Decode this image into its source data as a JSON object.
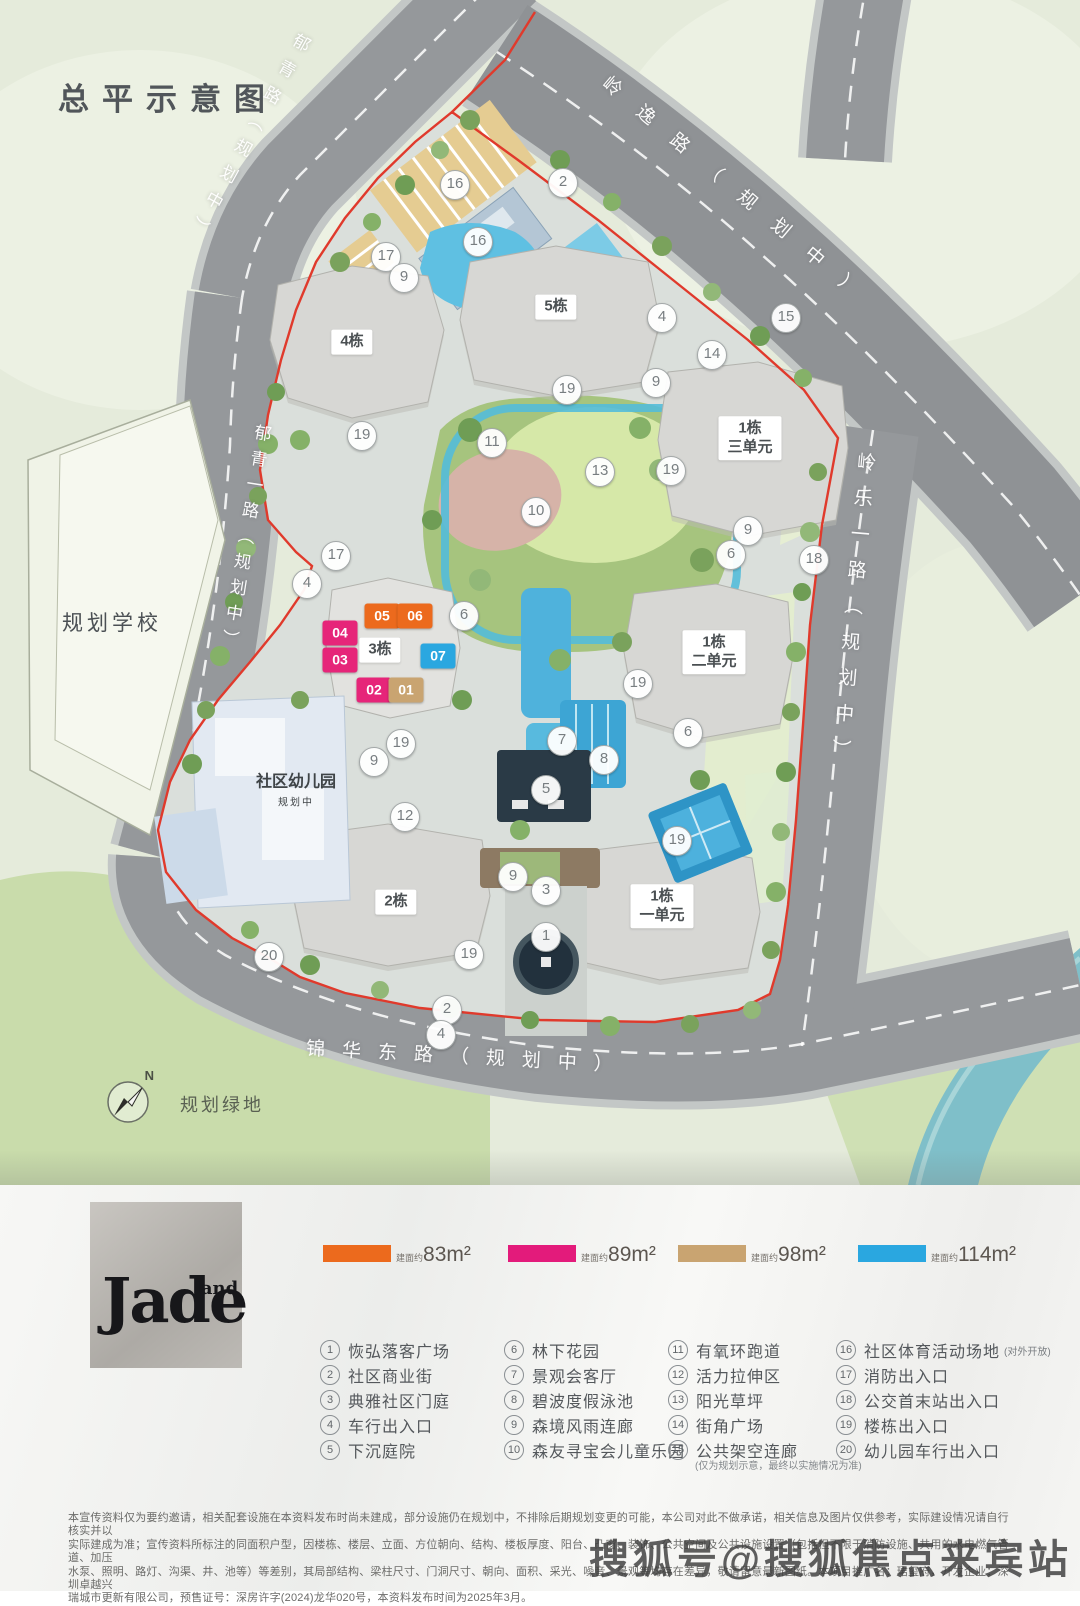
{
  "page_title": "总平示意图",
  "map": {
    "road_labels": {
      "yuqing": "郁青路（规划中）",
      "yuqing_yi": "郁青一路（规划中）",
      "lingyi": "岭逸路（规划中）",
      "lingle_yi": "岭乐一路（规划中）",
      "jinhua_east": "锦华东路（规划中）"
    },
    "area_labels": {
      "school": "规划学校",
      "kindergarten": "社区幼儿园",
      "kindergarten_note": "规划中",
      "green_space": "规划绿地",
      "compass": "N"
    },
    "building_labels": {
      "b4": "4栋",
      "b5": "5栋",
      "b3": "3栋",
      "b2": "2栋",
      "b1u3": "1栋\n三单元",
      "b1u2": "1栋\n二单元",
      "b1u1": "1栋\n一单元"
    },
    "unit_blocks": [
      {
        "no": "05",
        "color": "#EC6A1D",
        "x": 382,
        "y": 616
      },
      {
        "no": "06",
        "color": "#EC6A1D",
        "x": 415,
        "y": 616
      },
      {
        "no": "04",
        "color": "#E62579",
        "x": 340,
        "y": 633
      },
      {
        "no": "03",
        "color": "#E62579",
        "x": 340,
        "y": 660
      },
      {
        "no": "07",
        "color": "#2AA7E0",
        "x": 438,
        "y": 656
      },
      {
        "no": "02",
        "color": "#E62579",
        "x": 374,
        "y": 690
      },
      {
        "no": "01",
        "color": "#C9A471",
        "x": 406,
        "y": 690
      }
    ],
    "markers": [
      {
        "n": "16",
        "x": 455,
        "y": 185
      },
      {
        "n": "2",
        "x": 563,
        "y": 183
      },
      {
        "n": "17",
        "x": 386,
        "y": 257
      },
      {
        "n": "16",
        "x": 478,
        "y": 242
      },
      {
        "n": "9",
        "x": 404,
        "y": 278
      },
      {
        "n": "4",
        "x": 662,
        "y": 318
      },
      {
        "n": "15",
        "x": 786,
        "y": 318
      },
      {
        "n": "14",
        "x": 712,
        "y": 355
      },
      {
        "n": "9",
        "x": 656,
        "y": 383
      },
      {
        "n": "19",
        "x": 362,
        "y": 436
      },
      {
        "n": "11",
        "x": 492,
        "y": 443
      },
      {
        "n": "13",
        "x": 600,
        "y": 472
      },
      {
        "n": "19",
        "x": 671,
        "y": 471
      },
      {
        "n": "10",
        "x": 536,
        "y": 512
      },
      {
        "n": "9",
        "x": 748,
        "y": 531
      },
      {
        "n": "6",
        "x": 731,
        "y": 555
      },
      {
        "n": "18",
        "x": 814,
        "y": 560
      },
      {
        "n": "17",
        "x": 336,
        "y": 556
      },
      {
        "n": "4",
        "x": 307,
        "y": 584
      },
      {
        "n": "6",
        "x": 464,
        "y": 616
      },
      {
        "n": "19",
        "x": 638,
        "y": 684
      },
      {
        "n": "6",
        "x": 688,
        "y": 733
      },
      {
        "n": "9",
        "x": 374,
        "y": 762
      },
      {
        "n": "19",
        "x": 401,
        "y": 744
      },
      {
        "n": "12",
        "x": 405,
        "y": 817
      },
      {
        "n": "7",
        "x": 562,
        "y": 741
      },
      {
        "n": "5",
        "x": 546,
        "y": 790
      },
      {
        "n": "8",
        "x": 604,
        "y": 760
      },
      {
        "n": "9",
        "x": 513,
        "y": 877
      },
      {
        "n": "3",
        "x": 546,
        "y": 891
      },
      {
        "n": "1",
        "x": 546,
        "y": 937
      },
      {
        "n": "19",
        "x": 469,
        "y": 955
      },
      {
        "n": "2",
        "x": 447,
        "y": 1010
      },
      {
        "n": "4",
        "x": 441,
        "y": 1035
      },
      {
        "n": "19",
        "x": 677,
        "y": 841
      },
      {
        "n": "20",
        "x": 269,
        "y": 957
      },
      {
        "n": "19",
        "x": 567,
        "y": 390
      }
    ]
  },
  "legend": {
    "brand": {
      "main": "Jade",
      "sub": "land"
    },
    "swatches": [
      {
        "color": "#EC6A1D",
        "prefix": "建面约",
        "value": "83m²"
      },
      {
        "color": "#E31B7B",
        "prefix": "建面约",
        "value": "89m²"
      },
      {
        "color": "#C9A471",
        "prefix": "建面约",
        "value": "98m²"
      },
      {
        "color": "#2AA7E0",
        "prefix": "建面约",
        "value": "114m²"
      }
    ],
    "items": [
      {
        "n": "1",
        "label": "恢弘落客广场"
      },
      {
        "n": "2",
        "label": "社区商业街"
      },
      {
        "n": "3",
        "label": "典雅社区门庭"
      },
      {
        "n": "4",
        "label": "车行出入口"
      },
      {
        "n": "5",
        "label": "下沉庭院"
      },
      {
        "n": "6",
        "label": "林下花园"
      },
      {
        "n": "7",
        "label": "景观会客厅"
      },
      {
        "n": "8",
        "label": "碧波度假泳池"
      },
      {
        "n": "9",
        "label": "森境风雨连廊"
      },
      {
        "n": "10",
        "label": "森友寻宝会儿童乐园"
      },
      {
        "n": "11",
        "label": "有氧环跑道"
      },
      {
        "n": "12",
        "label": "活力拉伸区"
      },
      {
        "n": "13",
        "label": "阳光草坪"
      },
      {
        "n": "14",
        "label": "街角广场"
      },
      {
        "n": "15",
        "label": "公共架空连廊",
        "note_below": "(仅为规划示意，最终以实施情况为准)"
      },
      {
        "n": "16",
        "label": "社区体育活动场地",
        "note_inline": "(对外开放)"
      },
      {
        "n": "17",
        "label": "消防出入口"
      },
      {
        "n": "18",
        "label": "公交首末站出入口"
      },
      {
        "n": "19",
        "label": "楼栋出入口"
      },
      {
        "n": "20",
        "label": "幼儿园车行出入口"
      }
    ]
  },
  "disclaimer": "本宣传资料仅为要约邀请，相关配套设施在本资料发布时尚未建成，部分设施仍在规划中，不排除后期规划变更的可能，本公司对此不做承诺，相关信息及图片仅供参考，实际建设情况请自行核实并以\n实际建成为准；宣传资料所标注的同面积户型，因楼栋、楼层、立面、方位朝向、结构、楼板厚度、阳台、凸窗、装饰、公共空间及公共设施设置（包括但不限于消防设施、共用的水电燃气管道、加压\n水泵、照明、路灯、沟渠、井、池等）等差别，其局部结构、梁柱尺寸、门洞尺寸、朝向、面积、采光、噪音、景观等均存在差异，敬请留意最新图纸。本项目推广名：珺玺府，开发企业：深圳卓越兴\n瑞城市更新有限公司，预售证号：深房许字(2024)龙华020号，本资料发布时间为2025年3月。",
  "watermark": "搜狐号@搜狐焦点来宾站"
}
